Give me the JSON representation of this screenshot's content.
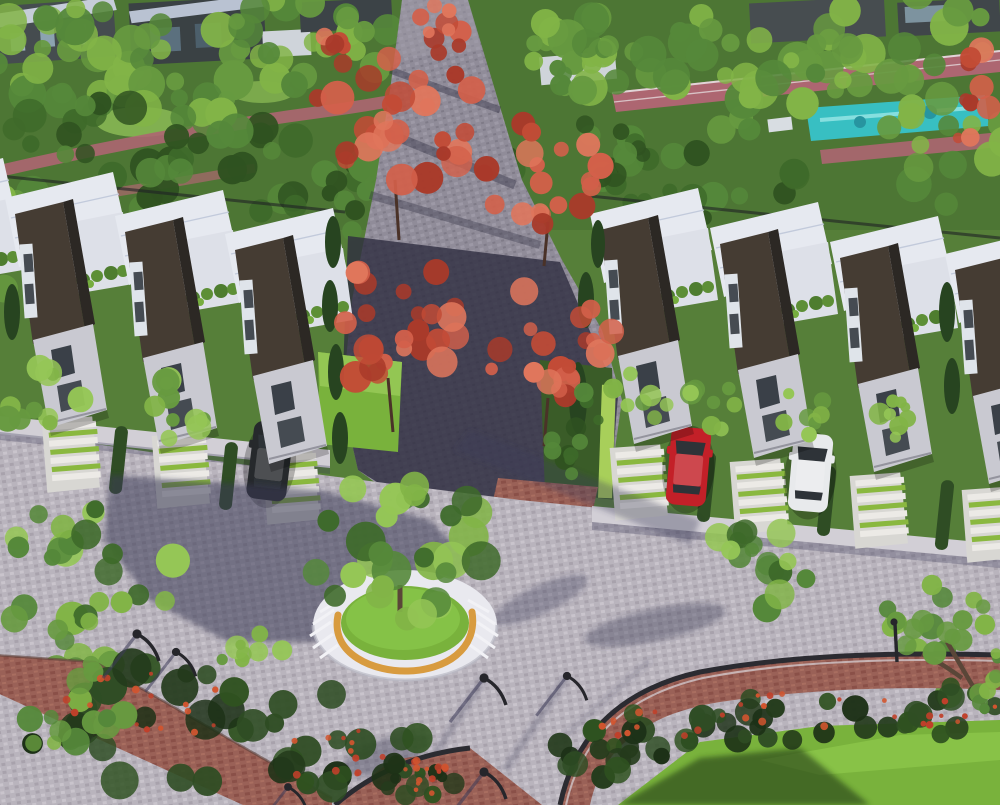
{
  "scene": {
    "description": "Bird's-eye architectural rendering of a modern townhouse community: two rows of white-roofed townhouses with dark angled facades and rooftop terraces, striped green-and-white driveways with a dark, a red and a white parked car, a central cobblestone walkway flanked by red-leaf trees, a circular tree planter with stepped seats and a curved orange bench on a large paved plaza, street lamps, brick-edged shrub borders, lawns, a pink jogging track and a turquoise pool at the top right.",
    "objects": [
      "left-townhouse-row",
      "right-townhouse-row",
      "central-walkway",
      "red-accent-trees",
      "circular-tree-planter",
      "curved-bench",
      "bench-steps",
      "central-plaza",
      "striped-driveways",
      "parked-car-dark",
      "parked-car-red",
      "parked-car-white",
      "street-lamps",
      "jogging-track",
      "swimming-pool",
      "shrub-borders",
      "lawns",
      "flower-bush"
    ]
  },
  "palette": {
    "foliage_dark": "#2f5220",
    "foliage_dark2": "#3e6a2a",
    "foliage_mid": "#55883a",
    "foliage_mid2": "#679a40",
    "foliage_bright": "#82b447",
    "foliage_bright2": "#95c656",
    "red1": "#a93a2a",
    "red2": "#c24b36",
    "red3": "#d3604a",
    "red4": "#e0765c",
    "shrub1": "#243b1c",
    "shrub2": "#2f4d24",
    "shrub3": "#1d3117",
    "flower_red": "#c0402a",
    "flower_red2": "#d2552f",
    "roof_white": "#e6e9f0",
    "roof_shade": "#c2cadb",
    "terrace": "#dde0e8",
    "wall_dark": "#453c33",
    "wall_edge": "#2c2824",
    "facade_light": "#c9c9d1",
    "window_dark": "#3a4048",
    "path_cobble": "#908c99",
    "plaza_cobble": "#b9b4bd",
    "sidewalk": "#d2cfd6",
    "shadow_blue": "#3d3b58",
    "path_shadow": "#2e2d40",
    "brick_red": "#9a6157",
    "track_pink": "#ad6671",
    "pool_water": "#38bfc2",
    "pool_light": "#8fe3e3",
    "lawn_green": "#79b23c",
    "lawn_bright": "#8fc94c",
    "planter_ring": "#e9e9ef",
    "bench_orange": "#d89b3f",
    "stripe_white": "#eceae6",
    "stripe_green": "#8ab83f",
    "drive_base": "#d8d7d3",
    "hedge_dark": "#2f4d24",
    "hedge_lime": "#a8cf5a",
    "car_red": "#c32028",
    "car_white": "#e8eaec",
    "car_dark": "#26292c",
    "lamp_black": "#26262b",
    "trunk_brown": "#5a4638"
  }
}
